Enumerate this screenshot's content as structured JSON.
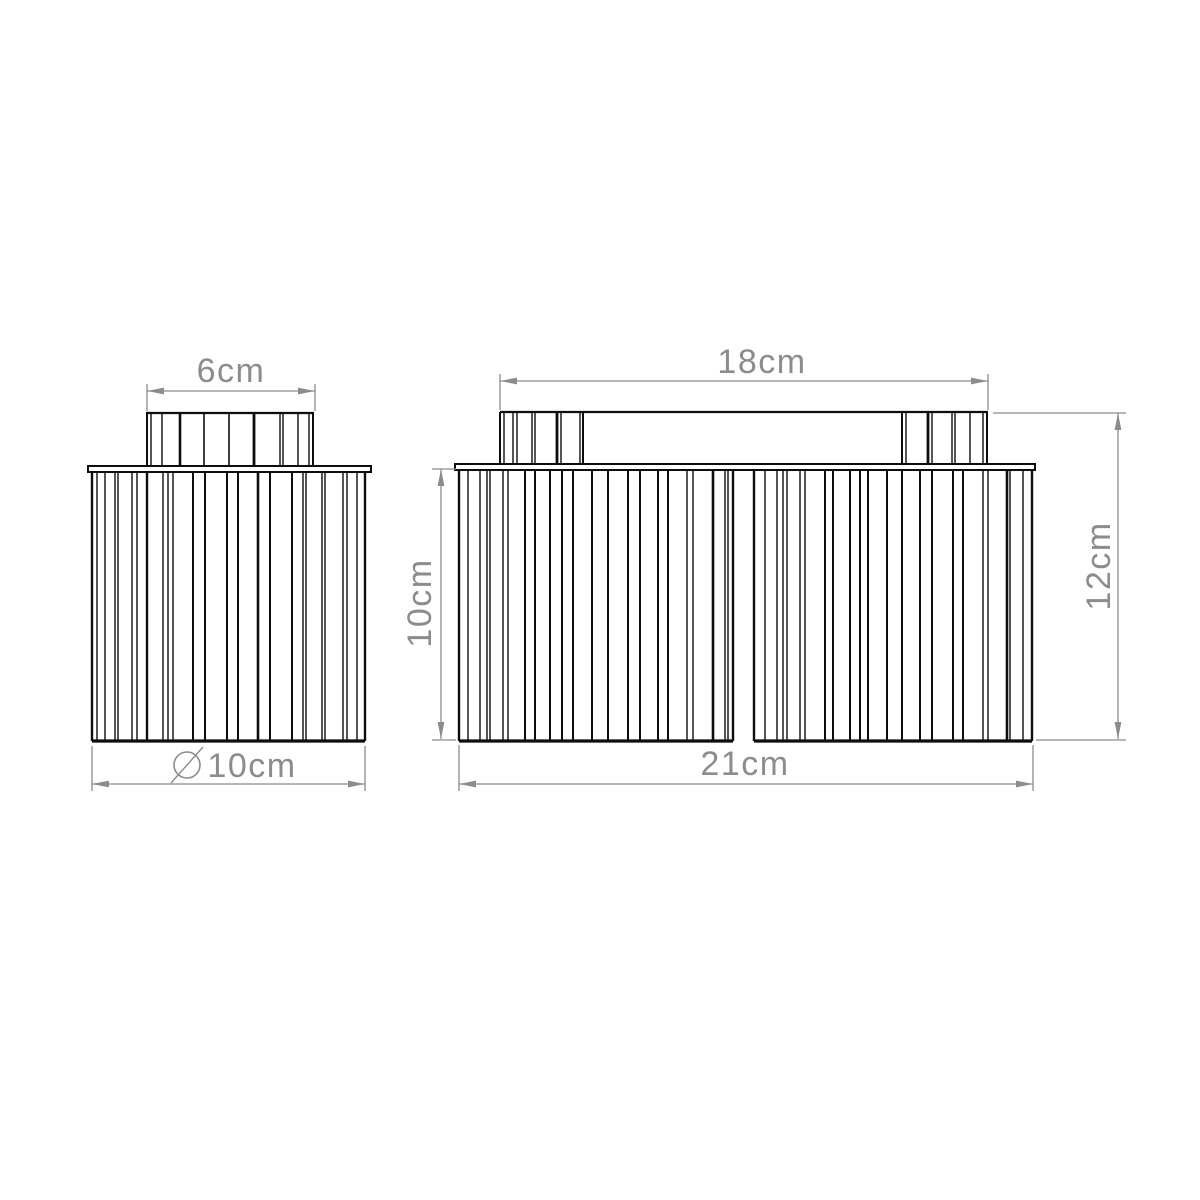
{
  "canvas": {
    "width": 1200,
    "height": 1200,
    "background": "#ffffff"
  },
  "style": {
    "ink_color": "#0d0d0d",
    "dimension_color": "#8c8c8c",
    "label_font_size": 34,
    "arrow_length": 17,
    "arrow_half_width": 3.4
  },
  "views": {
    "left": {
      "cap": {
        "top_line": {
          "x1": 146,
          "x2": 314,
          "y": 413
        },
        "rib_top": 413,
        "rib_bottom": 467,
        "ribs": [
          [
            147,
            2
          ],
          [
            151,
            1.4
          ],
          [
            162,
            1.4
          ],
          [
            180,
            2.6
          ],
          [
            204,
            1.6
          ],
          [
            229,
            1.6
          ],
          [
            254,
            2.8
          ],
          [
            280,
            1.4
          ],
          [
            283,
            1.4
          ],
          [
            298,
            1.4
          ],
          [
            309,
            1.4
          ],
          [
            313,
            2
          ]
        ]
      },
      "plate": {
        "x": 88,
        "y": 466,
        "width": 283,
        "height": 6
      },
      "body": {
        "rib_top": 472,
        "rib_bottom": 741,
        "ribs": [
          [
            92,
            2.4
          ],
          [
            97,
            1.4
          ],
          [
            105,
            1.4
          ],
          [
            115,
            1.4
          ],
          [
            118,
            1.4
          ],
          [
            132,
            1.4
          ],
          [
            137,
            1.4
          ],
          [
            147,
            2.4
          ],
          [
            163,
            1.4
          ],
          [
            168,
            1.4
          ],
          [
            173,
            1.4
          ],
          [
            193,
            2
          ],
          [
            205,
            2
          ],
          [
            227,
            2
          ],
          [
            238,
            2
          ],
          [
            258,
            2.6
          ],
          [
            270,
            2
          ],
          [
            292,
            2
          ],
          [
            303,
            1.4
          ],
          [
            306,
            1.4
          ],
          [
            322,
            1.4
          ],
          [
            325,
            1.4
          ],
          [
            343,
            1.4
          ],
          [
            347,
            1.4
          ],
          [
            357,
            1.4
          ],
          [
            365,
            2.4
          ]
        ],
        "bottom_line": {
          "x1": 92,
          "x2": 365,
          "y": 741
        }
      }
    },
    "right": {
      "top_line": {
        "x1": 500,
        "x2": 988,
        "y": 412
      },
      "caps": [
        {
          "rib_top": 412,
          "rib_bottom": 464,
          "ribs": [
            [
              500,
              2
            ],
            [
              504,
              1.4
            ],
            [
              513,
              1.4
            ],
            [
              517,
              1.4
            ],
            [
              532,
              1.4
            ],
            [
              535,
              1.4
            ],
            [
              557,
              2.8
            ],
            [
              561,
              1.4
            ],
            [
              580,
              1.4
            ],
            [
              583,
              2
            ]
          ]
        },
        {
          "rib_top": 412,
          "rib_bottom": 464,
          "ribs": [
            [
              902,
              2
            ],
            [
              906,
              1.4
            ],
            [
              928,
              2.8
            ],
            [
              932,
              1.4
            ],
            [
              952,
              1.4
            ],
            [
              955,
              1.4
            ],
            [
              970,
              1.4
            ],
            [
              983,
              1.4
            ],
            [
              987,
              2
            ]
          ]
        }
      ],
      "plate": {
        "x": 455,
        "y": 464,
        "width": 580,
        "height": 6
      },
      "drums": [
        {
          "rib_top": 470,
          "rib_bottom": 741,
          "ribs": [
            [
              459,
              2.4
            ],
            [
              468,
              1.4
            ],
            [
              480,
              1.4
            ],
            [
              487,
              1.4
            ],
            [
              490,
              1.4
            ],
            [
              503,
              1.4
            ],
            [
              508,
              1.4
            ],
            [
              525,
              2
            ],
            [
              535,
              2
            ],
            [
              550,
              2
            ],
            [
              562,
              2
            ],
            [
              573,
              2
            ],
            [
              592,
              2
            ],
            [
              608,
              2
            ],
            [
              628,
              2
            ],
            [
              640,
              2
            ],
            [
              658,
              2
            ],
            [
              668,
              2
            ],
            [
              687,
              1.4
            ],
            [
              693,
              1.4
            ],
            [
              713,
              2.6
            ],
            [
              725,
              1.4
            ],
            [
              728,
              1.4
            ],
            [
              733,
              2.4
            ]
          ],
          "bottom_line": {
            "x1": 459,
            "x2": 733,
            "y": 741
          }
        },
        {
          "rib_top": 470,
          "rib_bottom": 741,
          "ribs": [
            [
              754,
              2.4
            ],
            [
              765,
              1.4
            ],
            [
              777,
              1.4
            ],
            [
              783,
              1.4
            ],
            [
              787,
              1.4
            ],
            [
              800,
              1.4
            ],
            [
              805,
              1.4
            ],
            [
              825,
              2
            ],
            [
              833,
              2
            ],
            [
              850,
              2
            ],
            [
              860,
              2
            ],
            [
              868,
              2
            ],
            [
              887,
              2
            ],
            [
              902,
              2
            ],
            [
              920,
              2
            ],
            [
              932,
              2
            ],
            [
              953,
              2
            ],
            [
              963,
              2
            ],
            [
              983,
              1.4
            ],
            [
              988,
              1.4
            ],
            [
              1007,
              2.6
            ],
            [
              1010,
              1.4
            ],
            [
              1023,
              1.4
            ],
            [
              1032,
              2.4
            ]
          ],
          "bottom_line": {
            "x1": 754,
            "x2": 1032,
            "y": 741
          }
        }
      ]
    }
  },
  "dimensions": [
    {
      "id": "left-cap-width",
      "label": "6cm",
      "orientation": "horizontal",
      "line": {
        "x1": 147,
        "x2": 315,
        "y": 391
      },
      "extensions": [
        {
          "type": "v",
          "x": 147,
          "y1": 384,
          "y2": 411
        },
        {
          "type": "v",
          "x": 315,
          "y1": 384,
          "y2": 411
        }
      ],
      "label_pos": {
        "x": 231,
        "y": 371
      }
    },
    {
      "id": "left-diameter",
      "label": "10cm",
      "symbol": "diameter",
      "orientation": "horizontal",
      "line": {
        "x1": 92,
        "x2": 365,
        "y": 784
      },
      "extensions": [
        {
          "type": "v",
          "x": 92,
          "y1": 746,
          "y2": 791
        },
        {
          "type": "v",
          "x": 365,
          "y1": 746,
          "y2": 791
        }
      ],
      "label_pos": {
        "x": 252,
        "y": 766
      },
      "symbol_geo": {
        "cx": 187,
        "cy": 765,
        "r": 13,
        "slash": {
          "x1": 171,
          "y1": 783,
          "x2": 203,
          "y2": 747
        }
      }
    },
    {
      "id": "right-canopy-width",
      "label": "18cm",
      "orientation": "horizontal",
      "line": {
        "x1": 500,
        "x2": 988,
        "y": 381
      },
      "extensions": [
        {
          "type": "v",
          "x": 500,
          "y1": 374,
          "y2": 410
        },
        {
          "type": "v",
          "x": 988,
          "y1": 374,
          "y2": 410
        }
      ],
      "label_pos": {
        "x": 762,
        "y": 362
      }
    },
    {
      "id": "right-shade-height",
      "label": "10cm",
      "orientation": "vertical",
      "line": {
        "x": 441,
        "y1": 469,
        "y2": 739
      },
      "extensions": [
        {
          "type": "h",
          "y": 469,
          "x1": 432,
          "x2": 456
        },
        {
          "type": "h",
          "y": 740,
          "x1": 432,
          "x2": 456
        }
      ],
      "label_pos": {
        "x": 420,
        "y": 603
      }
    },
    {
      "id": "right-total-height",
      "label": "12cm",
      "orientation": "vertical",
      "line": {
        "x": 1118,
        "y1": 413,
        "y2": 739
      },
      "extensions": [
        {
          "type": "h",
          "y": 413,
          "x1": 993,
          "x2": 1126
        },
        {
          "type": "h",
          "y": 740,
          "x1": 1036,
          "x2": 1126
        }
      ],
      "label_pos": {
        "x": 1099,
        "y": 566
      }
    },
    {
      "id": "right-total-width",
      "label": "21cm",
      "orientation": "horizontal",
      "line": {
        "x1": 459,
        "x2": 1033,
        "y": 784
      },
      "extensions": [
        {
          "type": "v",
          "x": 459,
          "y1": 745,
          "y2": 791
        },
        {
          "type": "v",
          "x": 1033,
          "y1": 745,
          "y2": 791
        }
      ],
      "label_pos": {
        "x": 745,
        "y": 764
      }
    }
  ]
}
